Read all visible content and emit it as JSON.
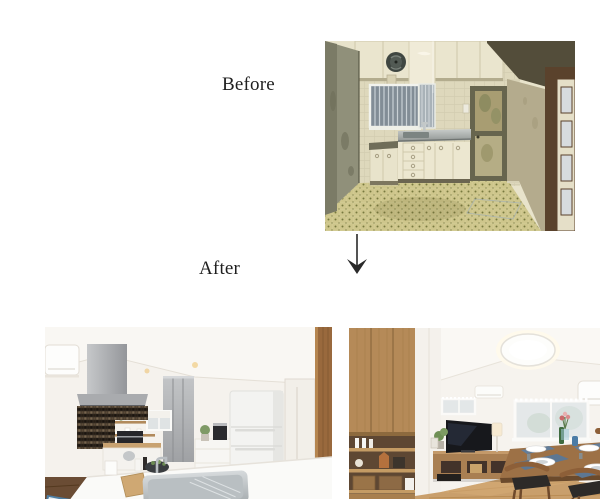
{
  "page": {
    "background": "#ffffff",
    "width": 600,
    "height": 499
  },
  "labels": {
    "before": "Before",
    "after": "After"
  },
  "arrow": {
    "glyph": "↓",
    "alt": "down arrow from before to after"
  },
  "photos": {
    "before": {
      "alt": "Dated kitchen before renovation: cream cabinets, wall fan, barred window, glass door, brown wooden door and yellow-green patterned tile floor"
    },
    "after_kitchen": {
      "alt": "Renovated white kitchen: range hood with dark mosaic tile accent, island counter with stainless sink, tall grey cabinet and white refrigerator"
    },
    "after_living": {
      "alt": "Renovated living-dining room: oak shelving unit, TV on low wooden board, dining table with navy placemats and wooden chairs, round ceiling light"
    }
  },
  "colors": {
    "label_ink": "#1f1f1f",
    "before_floor": "#cdc58a",
    "before_cabinet_cream": "#eae5ce",
    "after_wall_white": "#f5f2ed",
    "after_wood": "#b58a58",
    "after_placemat_blue": "#5d7793"
  }
}
